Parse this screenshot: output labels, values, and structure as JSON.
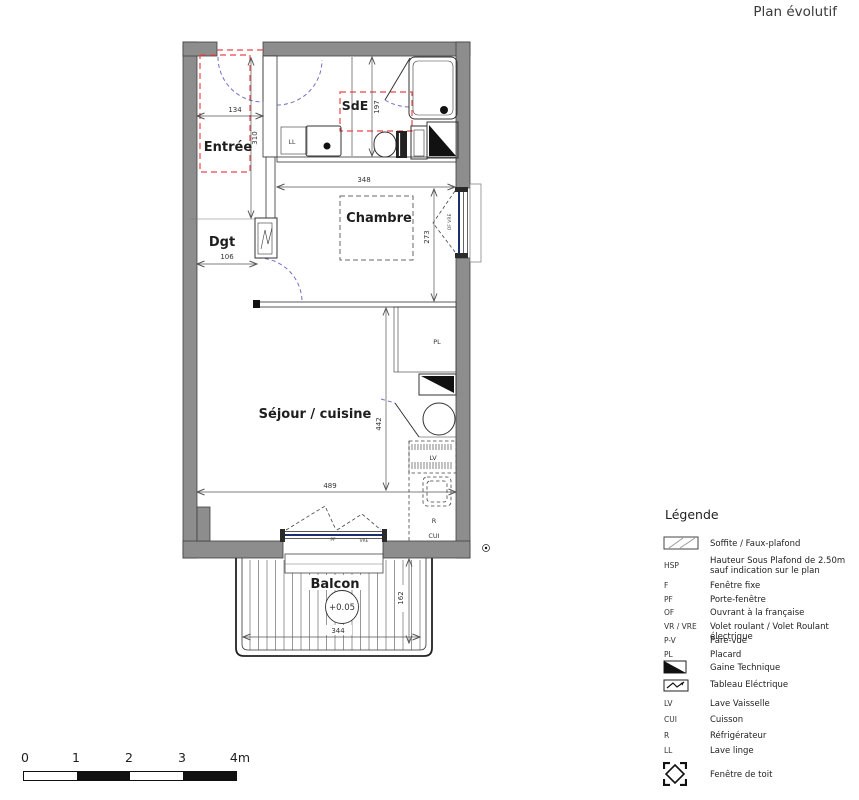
{
  "title": "Plan évolutif",
  "plan": {
    "rooms": {
      "entree": "Entrée",
      "sde": "SdE",
      "dgt": "Dgt",
      "chambre": "Chambre",
      "sejour": "Séjour / cuisine",
      "balcon": "Balcon"
    },
    "labels": {
      "ll": "LL",
      "pl": "PL",
      "lv": "LV",
      "fridge": "R",
      "cooking": "CUI",
      "pf": "PF",
      "vre": "VRE",
      "of_vre": "OF VRE",
      "balcony_level": "+0.05"
    },
    "dimensions": {
      "entree_width": "134",
      "entree_depth": "310",
      "dgt_width": "106",
      "sde_depth": "197",
      "chambre_width": "348",
      "chambre_depth": "273",
      "sejour_depth": "442",
      "sejour_width": "489",
      "balcon_width": "344",
      "balcon_depth": "162"
    }
  },
  "legend": {
    "heading": "Légende",
    "items": [
      {
        "abbr": "",
        "icon": "soffit",
        "label": "Soffite / Faux-plafond"
      },
      {
        "abbr": "HSP",
        "label": "Hauteur Sous Plafond de 2.50m",
        "label2": "sauf indication sur le plan"
      },
      {
        "abbr": "F",
        "label": "Fenêtre fixe"
      },
      {
        "abbr": "PF",
        "label": "Porte-fenêtre"
      },
      {
        "abbr": "OF",
        "label": "Ouvrant à la française"
      },
      {
        "abbr": "VR / VRE",
        "label": "Volet roulant / Volet Roulant électrique"
      },
      {
        "abbr": "P-V",
        "label": "Pare-vue"
      },
      {
        "abbr": "PL",
        "label": "Placard"
      },
      {
        "abbr": "",
        "icon": "gaine-technique",
        "label": "Gaine Technique"
      },
      {
        "abbr": "",
        "icon": "tableau-electrique",
        "label": "Tableau Eléctrique"
      },
      {
        "abbr": "LV",
        "label": "Lave Vaisselle"
      },
      {
        "abbr": "CUI",
        "label": "Cuisson"
      },
      {
        "abbr": "R",
        "label": "Réfrigérateur"
      },
      {
        "abbr": "LL",
        "label": "Lave linge"
      },
      {
        "abbr": "",
        "icon": "roof-window",
        "label": "Fenêtre de toit"
      }
    ]
  },
  "scalebar": {
    "ticks": [
      "0",
      "1",
      "2",
      "3",
      "4m"
    ]
  },
  "colors": {
    "wall": "#8d8d8d",
    "soffit": "#e8474b",
    "door_swing": "#7070c8",
    "glazing": "#1d2f6f"
  }
}
